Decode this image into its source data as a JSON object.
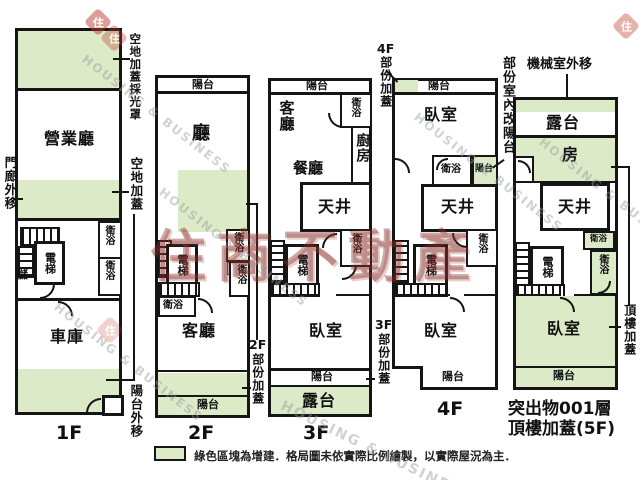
{
  "colors": {
    "addition_green": "#dceac8",
    "wall": "#151515",
    "brand_red": "#8b2f27"
  },
  "legend": {
    "note": "綠色區塊為增建．格局圖未依實際比例繪製，以實際屋況為主．"
  },
  "watermarks": {
    "diagonal": "HOUSING & BUSINESS",
    "brand": "住商不動產",
    "stamp": "住"
  },
  "floors": {
    "f1": {
      "caption": "1F",
      "hall": "營業廳",
      "garage": "車庫",
      "elevator": "電梯",
      "storage": "儲",
      "bath_upper": "衛浴",
      "bath_lower": "衛浴",
      "co_skylight": "空地加蓋採光罩",
      "co_porch": "門廊外移",
      "co_land": "空地加蓋",
      "co_balcony_out": "陽台外移"
    },
    "f2": {
      "caption": "2F",
      "balcony_top": "陽台",
      "hall": "廳",
      "living": "客廳",
      "elevator": "電梯",
      "bath_left": "衛浴",
      "bath_right_upper": "衛浴",
      "bath_right_lower": "衛浴",
      "balcony_bottom": "陽台",
      "co_prefix": "2F",
      "co_text": "部份加蓋"
    },
    "f3": {
      "caption": "3F",
      "balcony_top": "陽台",
      "living": "客廳",
      "bath_top": "衛浴",
      "kitchen": "廚房",
      "dining": "餐廳",
      "lightwell": "天井",
      "elevator": "電梯",
      "bath_mid": "衛浴",
      "bedroom": "臥室",
      "balcony_bottom": "陽台",
      "terrace": "露台",
      "co_prefix": "3F",
      "co_text": "部份加蓋"
    },
    "f4": {
      "caption": "4F",
      "balcony_top": "陽台",
      "bedroom_top": "臥室",
      "bath_top": "衛浴",
      "balcony_small": "陽台",
      "lightwell": "天井",
      "elevator": "電梯",
      "bath_mid": "衛浴",
      "bedroom": "臥室",
      "balcony_bottom": "陽台",
      "co_top_prefix": "4F",
      "co_top_text": "部份加蓋",
      "co_right": "部份室內改陽台"
    },
    "f5": {
      "caption_line1": "突出物001層",
      "caption_line2": "頂樓加蓋(5F)",
      "co_machine": "機械室外移",
      "terrace": "露台",
      "room": "房",
      "lightwell": "天井",
      "elevator": "電梯",
      "bath_small": "衛浴",
      "bath": "衛浴",
      "bedroom": "臥室",
      "balcony": "陽台",
      "co_right": "頂樓加蓋"
    }
  }
}
